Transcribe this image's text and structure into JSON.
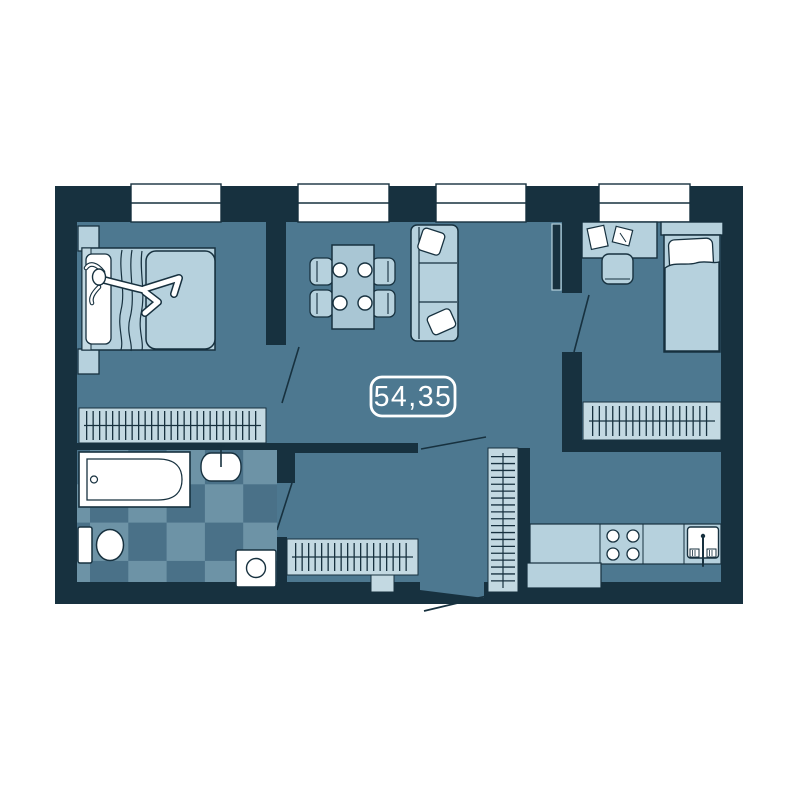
{
  "plan": {
    "area_label": "54,35",
    "windows_count": 4,
    "colors": {
      "background": "#ffffff",
      "wall": "#17313f",
      "floor": "#4d7890",
      "furniture": "#b6d1dd",
      "furniture_mid": "#a9c6d4",
      "wardrobe": "#c3d9e2",
      "tile_light": "#6d93a6",
      "tile_dark": "#4a7188",
      "fixture_white": "#ffffff"
    },
    "rooms": [
      {
        "name": "bedroom-master",
        "furniture": [
          "double-bed",
          "person-lying",
          "nightstand-top",
          "nightstand-bottom",
          "wardrobe"
        ]
      },
      {
        "name": "living-dining-room",
        "furniture": [
          "dining-table",
          "chairs-x4",
          "plates-x4",
          "sofa",
          "sofa-pillows-x2",
          "tv"
        ]
      },
      {
        "name": "bedroom-second",
        "furniture": [
          "desk",
          "desk-papers",
          "desk-chair",
          "single-bed",
          "wardrobe"
        ]
      },
      {
        "name": "bathroom",
        "furniture": [
          "bathtub",
          "washbasin",
          "toilet",
          "washing-machine",
          "checker-tile-floor"
        ]
      },
      {
        "name": "hallway",
        "furniture": [
          "wardrobe-long",
          "wardrobe-tall",
          "shoe-cabinet"
        ]
      },
      {
        "name": "kitchen",
        "furniture": [
          "counter",
          "stove-4-burners",
          "kitchen-sink",
          "counter-extension"
        ]
      }
    ],
    "doors": [
      "bedroom-master-door",
      "bedroom-second-door",
      "bathroom-door",
      "hallway-door",
      "entrance-door"
    ]
  }
}
